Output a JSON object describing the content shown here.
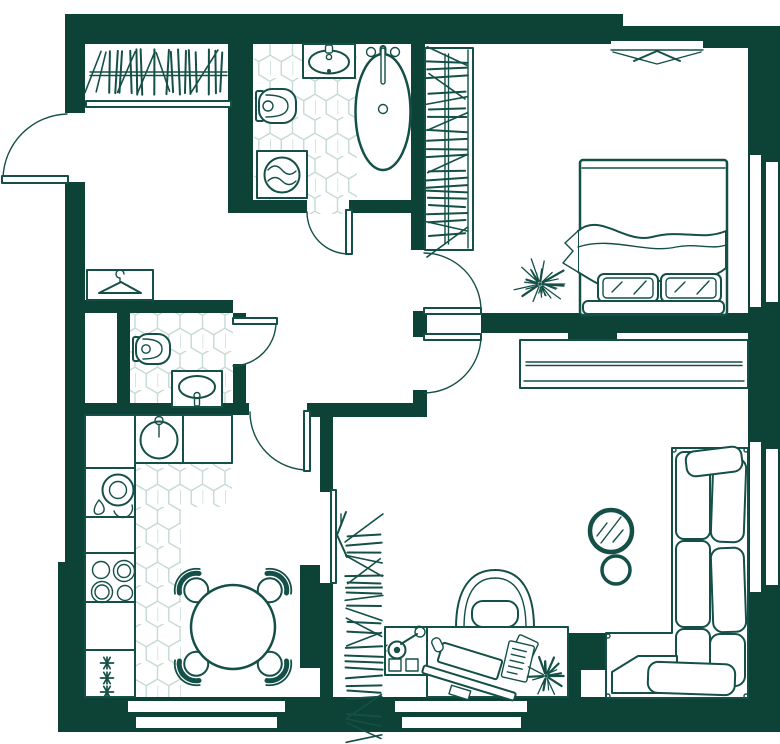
{
  "page": {
    "title": "Apartment floor plan drawing"
  },
  "colors": {
    "wall": "#0d4237",
    "line": "#145047",
    "tile": "#c6dad4",
    "paper": "#ffffff"
  },
  "rooms": [
    {
      "name": "entry-hall"
    },
    {
      "name": "bathroom"
    },
    {
      "name": "wc"
    },
    {
      "name": "bedroom"
    },
    {
      "name": "kitchen-dining"
    },
    {
      "name": "living-room"
    }
  ],
  "fixtures": [
    {
      "name": "entry-door-swing"
    },
    {
      "name": "coat-closet-hanging-rail"
    },
    {
      "name": "coat-hanger-symbol"
    },
    {
      "name": "bathroom-hex-tile-floor"
    },
    {
      "name": "bathroom-sink"
    },
    {
      "name": "bathroom-toilet"
    },
    {
      "name": "washing-machine"
    },
    {
      "name": "freestanding-bathtub"
    },
    {
      "name": "bedroom-wardrobe-rail"
    },
    {
      "name": "living-wardrobe-rail"
    },
    {
      "name": "wc-toilet"
    },
    {
      "name": "wc-sink"
    },
    {
      "name": "kitchen-sink"
    },
    {
      "name": "dish-rack"
    },
    {
      "name": "stove-burners"
    },
    {
      "name": "freezer-asterisks"
    },
    {
      "name": "dining-table-4-chairs"
    },
    {
      "name": "desk-with-monitor-keyboard"
    },
    {
      "name": "desk-chair"
    },
    {
      "name": "desk-lamp-cabinet"
    },
    {
      "name": "notepad"
    },
    {
      "name": "desk-plant"
    },
    {
      "name": "bedroom-plant"
    },
    {
      "name": "corner-sofa"
    },
    {
      "name": "wall-mirror"
    },
    {
      "name": "pouf"
    },
    {
      "name": "double-bed-with-pillows"
    },
    {
      "name": "folding-door"
    },
    {
      "name": "duct-shaft"
    }
  ],
  "windows": {
    "count": 5,
    "locations": [
      "top-bedroom",
      "right-bedroom",
      "right-living",
      "bottom-kitchen",
      "bottom-living"
    ]
  },
  "doors": {
    "count": 7,
    "locations": [
      "entry",
      "bathroom",
      "wc",
      "kitchen",
      "bedroom",
      "living",
      "folding-kitchen-living"
    ]
  }
}
